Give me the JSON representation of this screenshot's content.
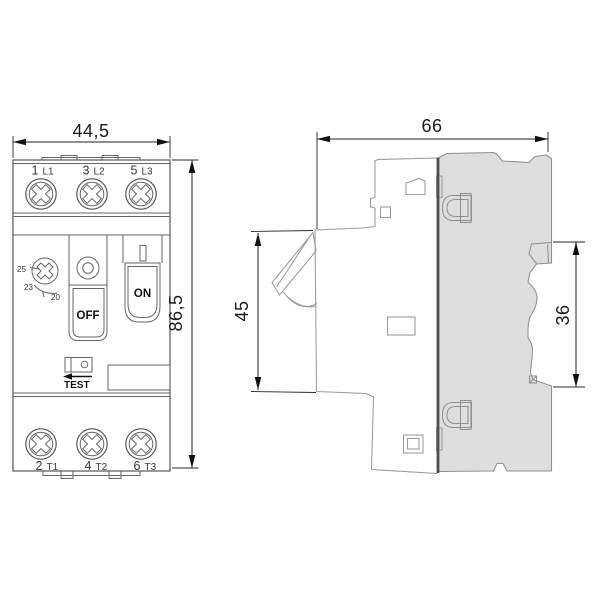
{
  "drawing": {
    "front_view": {
      "width_label": "44,5",
      "height_label": "86,5",
      "top_terminals": [
        {
          "num": "1",
          "phase": "L1"
        },
        {
          "num": "3",
          "phase": "L2"
        },
        {
          "num": "5",
          "phase": "L3"
        }
      ],
      "bottom_terminals": [
        {
          "num": "2",
          "phase": "T1"
        },
        {
          "num": "4",
          "phase": "T2"
        },
        {
          "num": "6",
          "phase": "T3"
        }
      ],
      "dial_scale_labels": [
        "25",
        "23",
        "20"
      ],
      "off_button": "OFF",
      "on_button": "ON",
      "test_label": "TEST"
    },
    "side_view": {
      "width_label": "66",
      "front_depth_label": "45",
      "rail_section_label": "36"
    },
    "colors": {
      "body_fill": "#dedede",
      "outline": "#555555",
      "dimension_text": "#1a1a1a"
    }
  }
}
